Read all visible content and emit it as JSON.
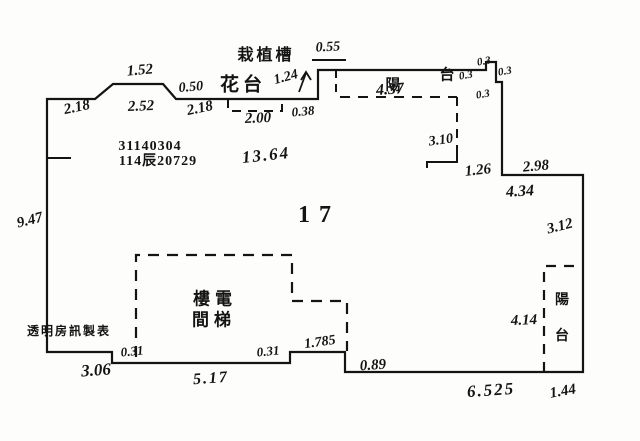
{
  "plan": {
    "unit_number": "17",
    "registration_numbers": [
      "31140304",
      "114辰20729"
    ],
    "watermark": "透明房訊製表",
    "areas": {
      "planter_trough": "栽植槽",
      "flower_bed": "花台",
      "balcony_top": "陽台",
      "balcony_right": "陽台",
      "stair_elevator_shaft": "樓電間梯"
    },
    "ink_color": "#141414",
    "paper_color": "#fdfdfc"
  },
  "labels": [
    {
      "name": "dim-1-52",
      "t": "1.52",
      "x": 140,
      "y": 71,
      "fs": 15,
      "rot": -5,
      "cls": "hw"
    },
    {
      "name": "dim-2-52",
      "t": "2.52",
      "x": 141,
      "y": 107,
      "fs": 15,
      "rot": -2,
      "cls": "hw"
    },
    {
      "name": "dim-2-18-left",
      "t": "2.18",
      "x": 77,
      "y": 108,
      "fs": 15,
      "rot": -12,
      "cls": "hw"
    },
    {
      "name": "dim-0-50",
      "t": "0.50",
      "x": 191,
      "y": 88,
      "fs": 14,
      "rot": -5,
      "cls": "hw"
    },
    {
      "name": "dim-2-18-mid",
      "t": "2.18",
      "x": 200,
      "y": 109,
      "fs": 15,
      "rot": -12,
      "cls": "hw"
    },
    {
      "name": "label-flower-bed",
      "t": "花台",
      "x": 243,
      "y": 85,
      "fs": 19,
      "rot": 0,
      "cls": "cjk",
      "ls": 4
    },
    {
      "name": "dim-1-24",
      "t": "1.24",
      "x": 286,
      "y": 78,
      "fs": 14,
      "rot": -15,
      "cls": "hw"
    },
    {
      "name": "label-planter-trough",
      "t": "栽植槽",
      "x": 266,
      "y": 55,
      "fs": 16,
      "rot": 0,
      "cls": "cjk",
      "ls": 3
    },
    {
      "name": "dim-0-55",
      "t": "0.55",
      "x": 328,
      "y": 48,
      "fs": 14,
      "rot": -3,
      "cls": "hw"
    },
    {
      "name": "dim-2-00",
      "t": "2.00",
      "x": 258,
      "y": 119,
      "fs": 15,
      "rot": -2,
      "cls": "hw"
    },
    {
      "name": "dim-0-38",
      "t": "0.38",
      "x": 303,
      "y": 111,
      "fs": 13,
      "rot": -5,
      "cls": "hw"
    },
    {
      "name": "label-balcony-top-char-1",
      "t": "陽",
      "x": 393,
      "y": 85,
      "fs": 15,
      "rot": 0,
      "cls": "cjk"
    },
    {
      "name": "label-balcony-top-char-2",
      "t": "台",
      "x": 447,
      "y": 75,
      "fs": 15,
      "rot": 0,
      "cls": "cjk"
    },
    {
      "name": "dim-4-37",
      "t": "4.37",
      "x": 390,
      "y": 90,
      "fs": 16,
      "rot": -4,
      "cls": "hw"
    },
    {
      "name": "dim-0-3-a",
      "t": "0.3",
      "x": 466,
      "y": 76,
      "fs": 11,
      "rot": -10,
      "cls": "hw"
    },
    {
      "name": "dim-0-3-b",
      "t": "0.3",
      "x": 484,
      "y": 62,
      "fs": 11,
      "rot": -10,
      "cls": "hw"
    },
    {
      "name": "dim-0-3-c",
      "t": "0.3",
      "x": 505,
      "y": 72,
      "fs": 11,
      "rot": -10,
      "cls": "hw"
    },
    {
      "name": "dim-0-3-d",
      "t": "0.3",
      "x": 483,
      "y": 95,
      "fs": 11,
      "rot": -10,
      "cls": "hw"
    },
    {
      "name": "dim-3-10",
      "t": "3.10",
      "x": 441,
      "y": 141,
      "fs": 14,
      "rot": -8,
      "cls": "hw"
    },
    {
      "name": "dim-1-26",
      "t": "1.26",
      "x": 478,
      "y": 171,
      "fs": 15,
      "rot": -6,
      "cls": "hw"
    },
    {
      "name": "dim-2-98",
      "t": "2.98",
      "x": 536,
      "y": 167,
      "fs": 15,
      "rot": -5,
      "cls": "hw"
    },
    {
      "name": "dim-4-34",
      "t": "4.34",
      "x": 520,
      "y": 192,
      "fs": 16,
      "rot": -3,
      "cls": "hw"
    },
    {
      "name": "dim-3-12",
      "t": "3.12",
      "x": 560,
      "y": 227,
      "fs": 15,
      "rot": -14,
      "cls": "hw"
    },
    {
      "name": "registration-number-1",
      "t": "31140304",
      "x": 150,
      "y": 147,
      "fs": 14,
      "rot": 0,
      "cls": "printed",
      "ls": 1
    },
    {
      "name": "registration-number-2",
      "t": "114辰20729",
      "x": 158,
      "y": 162,
      "fs": 14,
      "rot": 0,
      "cls": "printed",
      "ls": 1
    },
    {
      "name": "dim-13-64",
      "t": "13.64",
      "x": 266,
      "y": 155,
      "fs": 17,
      "rot": -6,
      "cls": "hw",
      "ls": 2
    },
    {
      "name": "unit-number",
      "t": "17",
      "x": 319,
      "y": 215,
      "fs": 24,
      "rot": 0,
      "cls": "printed",
      "ls": 9
    },
    {
      "name": "dim-9-47",
      "t": "9.47",
      "x": 30,
      "y": 221,
      "fs": 15,
      "rot": -14,
      "cls": "hw"
    },
    {
      "name": "watermark-text",
      "t": "透明房訊製表",
      "x": 69,
      "y": 331,
      "fs": 12,
      "rot": 0,
      "cls": "cjk",
      "ls": 2
    },
    {
      "name": "dim-3-06",
      "t": "3.06",
      "x": 96,
      "y": 370,
      "fs": 17,
      "rot": -4,
      "cls": "hw"
    },
    {
      "name": "dim-0-31-left",
      "t": "0.31",
      "x": 132,
      "y": 351,
      "fs": 13,
      "rot": -6,
      "cls": "hw"
    },
    {
      "name": "label-stairs-line-1",
      "t": "樓電",
      "x": 215,
      "y": 300,
      "fs": 17,
      "rot": 0,
      "cls": "cjk",
      "ls": 5
    },
    {
      "name": "label-stairs-line-2",
      "t": "間梯",
      "x": 214,
      "y": 321,
      "fs": 17,
      "rot": 0,
      "cls": "cjk",
      "ls": 5
    },
    {
      "name": "dim-0-31-right",
      "t": "0.31",
      "x": 268,
      "y": 351,
      "fs": 13,
      "rot": -6,
      "cls": "hw"
    },
    {
      "name": "dim-5-17",
      "t": "5.17",
      "x": 211,
      "y": 379,
      "fs": 16,
      "rot": -4,
      "cls": "hw",
      "ls": 2
    },
    {
      "name": "dim-1-785",
      "t": "1.785",
      "x": 320,
      "y": 343,
      "fs": 14,
      "rot": -8,
      "cls": "hw"
    },
    {
      "name": "dim-0-89",
      "t": "0.89",
      "x": 373,
      "y": 366,
      "fs": 15,
      "rot": -4,
      "cls": "hw"
    },
    {
      "name": "dim-4-14",
      "t": "4.14",
      "x": 524,
      "y": 321,
      "fs": 15,
      "rot": -2,
      "cls": "hw"
    },
    {
      "name": "label-balcony-right-char-1",
      "t": "陽",
      "x": 562,
      "y": 300,
      "fs": 14,
      "rot": 0,
      "cls": "cjk"
    },
    {
      "name": "label-balcony-right-char-2",
      "t": "台",
      "x": 562,
      "y": 336,
      "fs": 14,
      "rot": 0,
      "cls": "cjk"
    },
    {
      "name": "dim-6-525",
      "t": "6.525",
      "x": 491,
      "y": 390,
      "fs": 17,
      "rot": -4,
      "cls": "hw",
      "ls": 2
    },
    {
      "name": "dim-1-44",
      "t": "1.44",
      "x": 563,
      "y": 392,
      "fs": 15,
      "rot": -10,
      "cls": "hw"
    }
  ]
}
